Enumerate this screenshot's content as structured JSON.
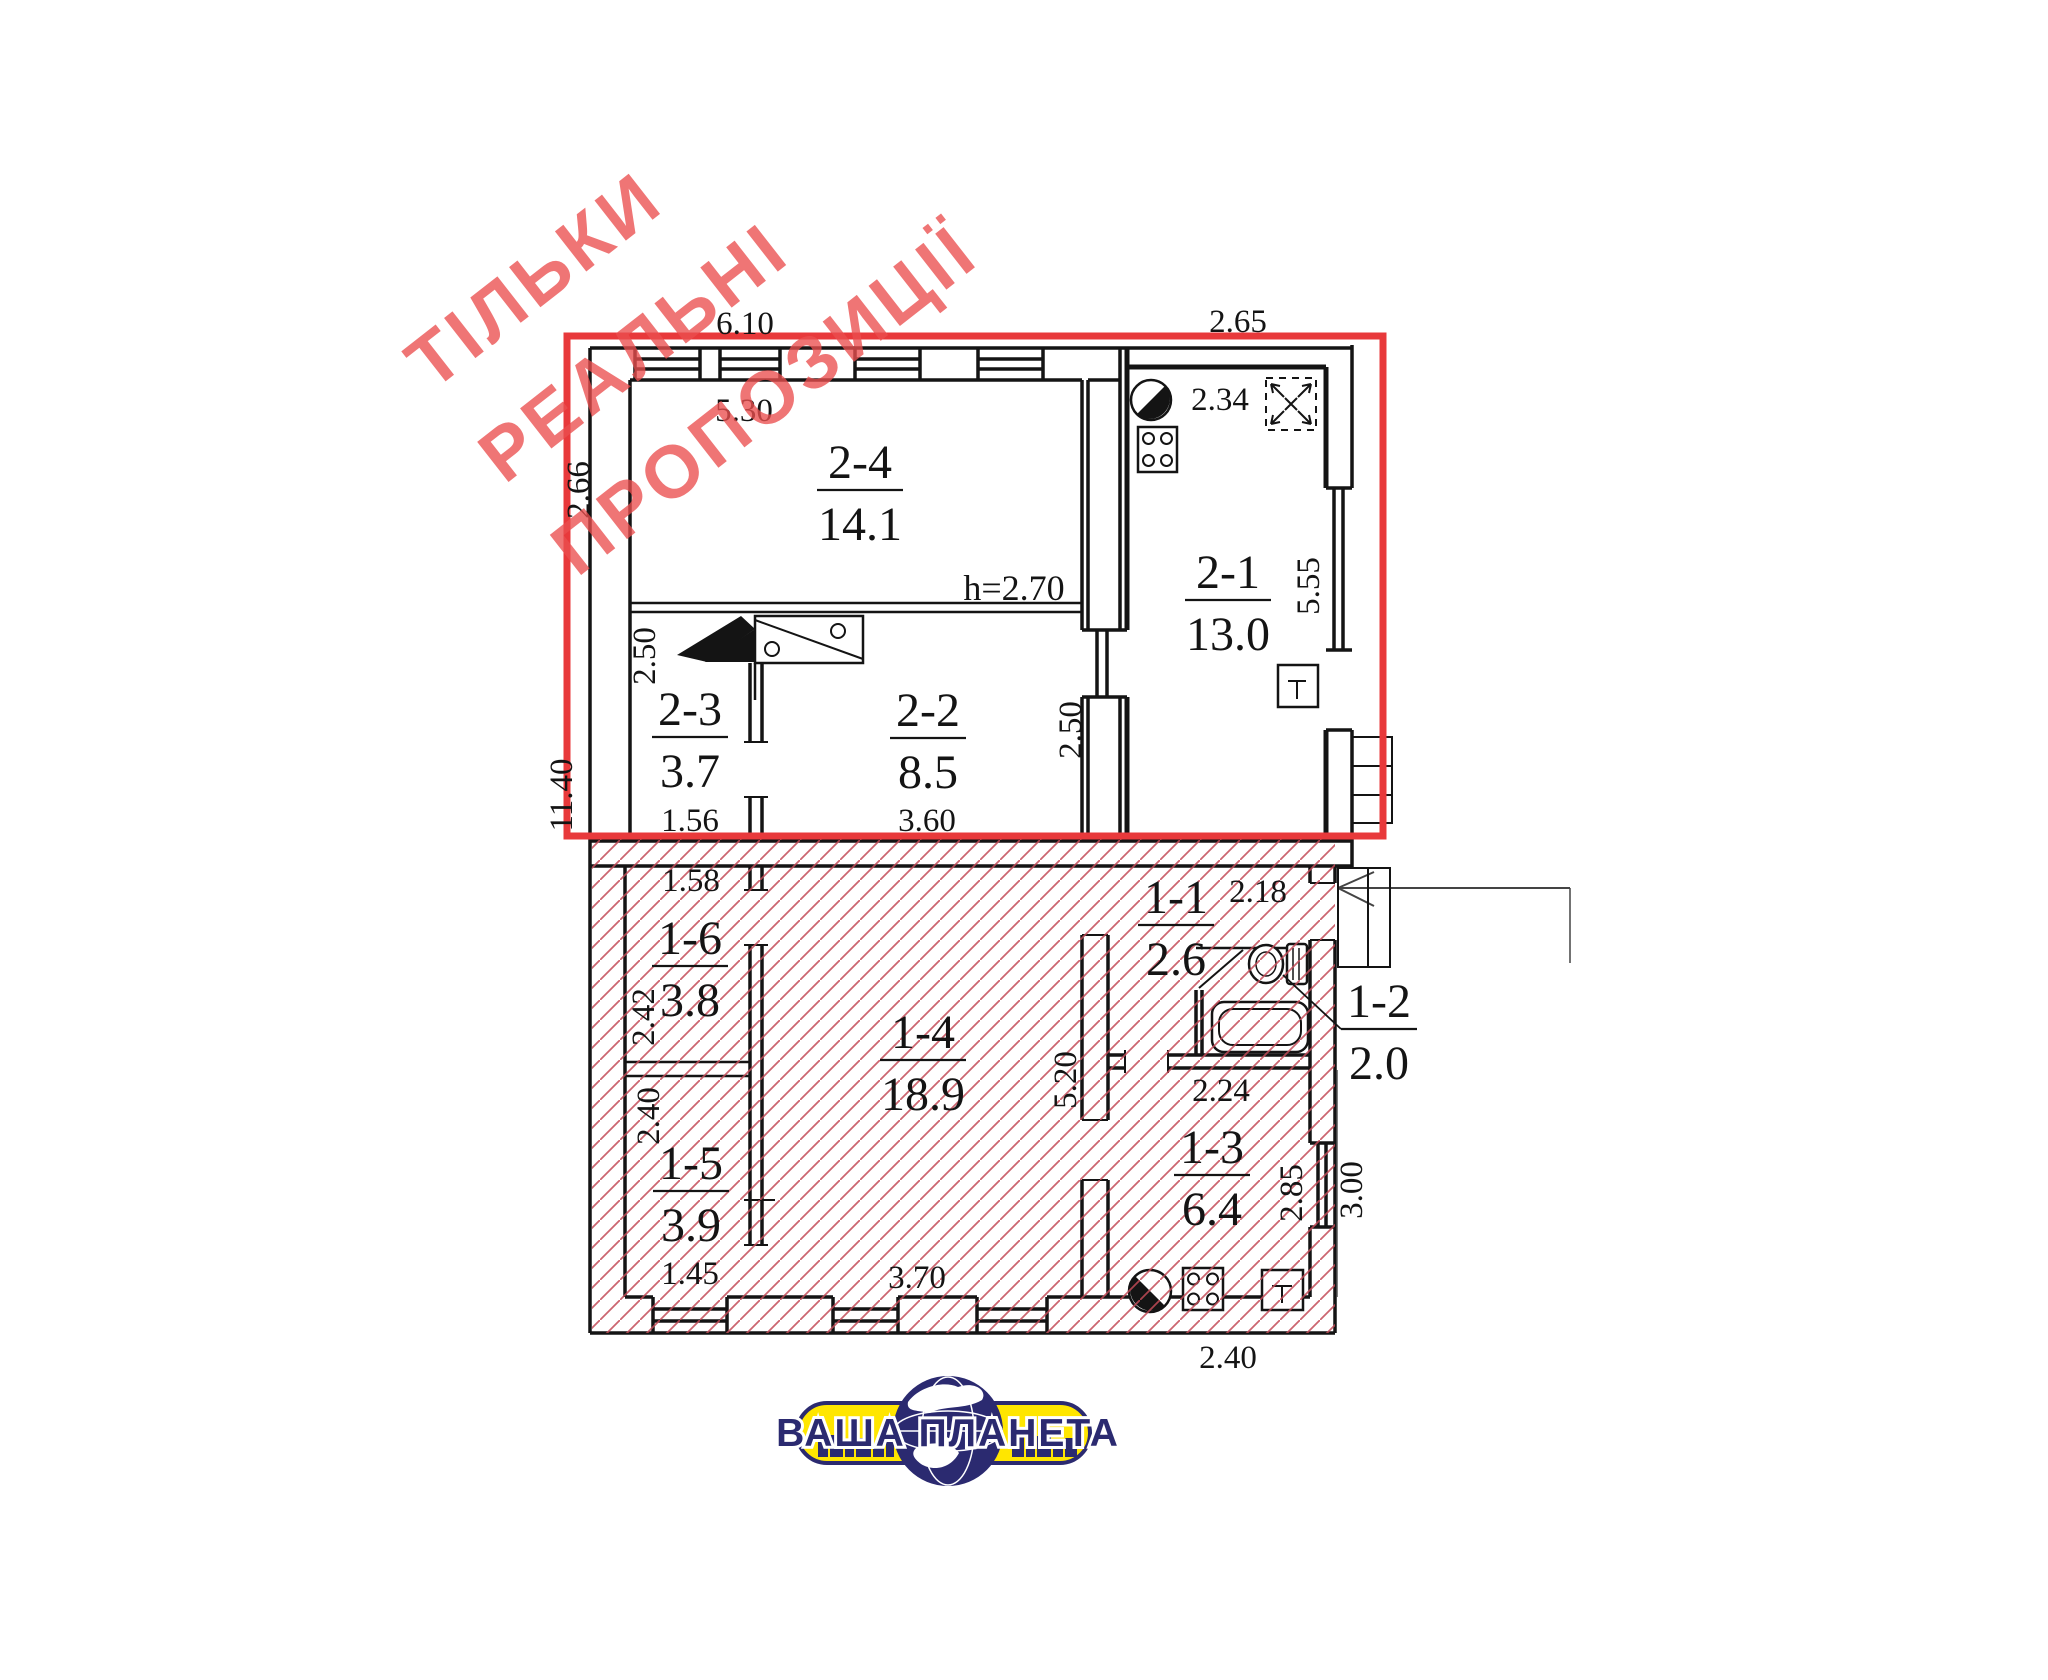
{
  "colors": {
    "selection_red": "#e8393b",
    "hatch_red": "#c34a57",
    "watermark_pink": "#eb4e4e",
    "wall_black": "#141414",
    "logo_yellow": "#ffe600",
    "logo_navy": "#2b2a70"
  },
  "watermark": {
    "line1": "ТІЛЬКИ",
    "line2": "РЕАЛЬНІ",
    "line3": "ПРОПОЗИЦІЇ"
  },
  "plan": {
    "height_note": "h=2.70",
    "rooms": {
      "r24": {
        "id": "2-4",
        "area": "14.1"
      },
      "r21": {
        "id": "2-1",
        "area": "13.0"
      },
      "r23": {
        "id": "2-3",
        "area": "3.7"
      },
      "r22": {
        "id": "2-2",
        "area": "8.5"
      },
      "r16": {
        "id": "1-6",
        "area": "3.8"
      },
      "r15": {
        "id": "1-5",
        "area": "3.9"
      },
      "r14": {
        "id": "1-4",
        "area": "18.9"
      },
      "r11": {
        "id": "1-1",
        "area": "2.6"
      },
      "r12": {
        "id": "1-2",
        "area": "2.0"
      },
      "r13": {
        "id": "1-3",
        "area": "6.4"
      }
    },
    "dims": {
      "d610": "6.10",
      "d265": "2.65",
      "d530": "5.30",
      "d234": "2.34",
      "d266": "2.66",
      "d250a": "2.50",
      "d250b": "2.50",
      "d555": "5.55",
      "d156": "1.56",
      "d360": "3.60",
      "d1140": "11.40",
      "d158": "1.58",
      "d242": "2.42",
      "d240a": "2.40",
      "d145": "1.45",
      "d370": "3.70",
      "d520": "5.20",
      "d218": "2.18",
      "d224": "2.24",
      "d285": "2.85",
      "d300": "3.00",
      "d240b": "2.40"
    }
  },
  "logo": {
    "brand": "ВАША ПЛАНЕТА"
  }
}
